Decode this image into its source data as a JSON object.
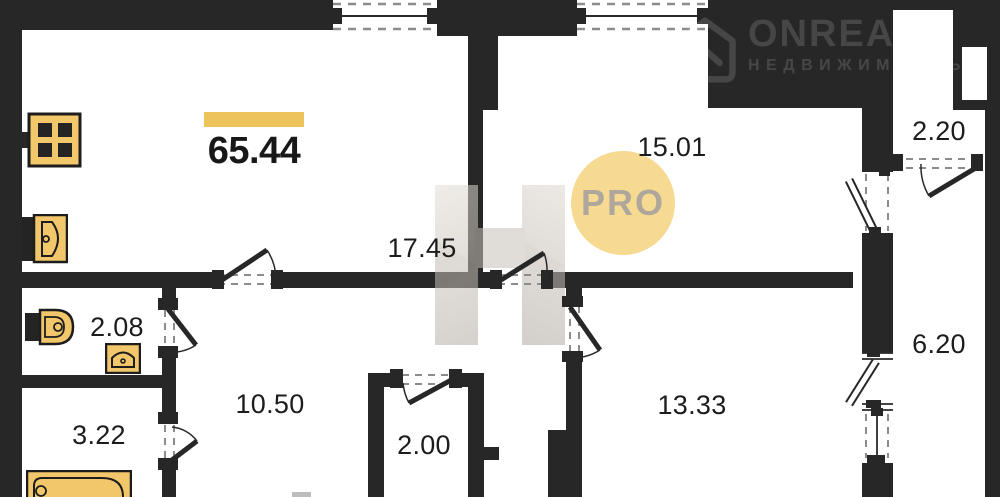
{
  "plan": {
    "total_area": "65.44",
    "badge": "PRO",
    "rooms": [
      {
        "id": "living-kitchen",
        "area": "17.45"
      },
      {
        "id": "bedroom",
        "area": "15.01"
      },
      {
        "id": "wardrobe",
        "area": "2.20"
      },
      {
        "id": "loggia",
        "area": "6.20"
      },
      {
        "id": "wc",
        "area": "2.08"
      },
      {
        "id": "bathroom",
        "area": "3.22"
      },
      {
        "id": "hallway",
        "area": "10.50"
      },
      {
        "id": "closet",
        "area": "2.00"
      },
      {
        "id": "bedroom-2",
        "area": "13.33"
      }
    ],
    "icons": [
      "stove-icon",
      "kitchen-sink-icon",
      "toilet-icon",
      "washbasin-icon",
      "bathtub-icon",
      "house-logo-icon"
    ]
  },
  "watermark": {
    "brand": "ONREALT",
    "subtitle": "НЕДВИЖИМОСТЬ"
  },
  "colors": {
    "wall": "#272727",
    "accent_yellow": "#edc45c",
    "fixture_yellow": "#f2c66b",
    "pro_circle": "#f7d88a",
    "pro_text": "#a9a195"
  }
}
